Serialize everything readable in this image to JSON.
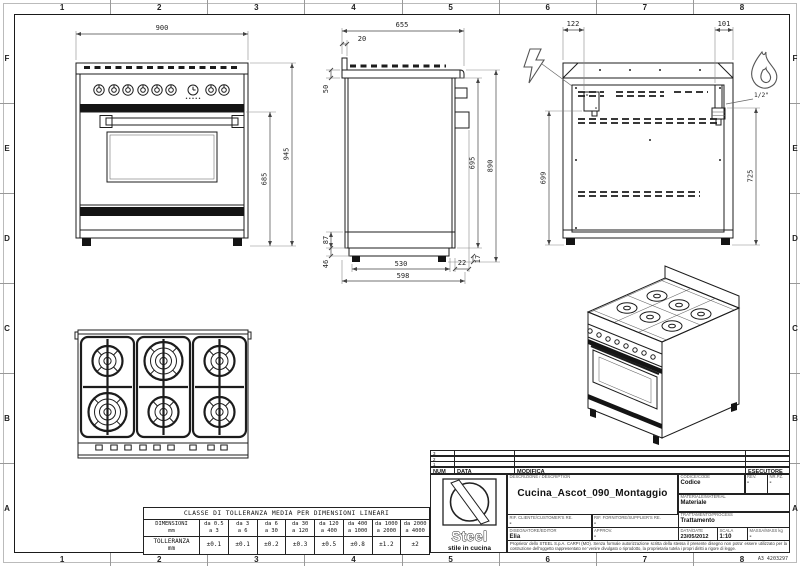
{
  "sheet_code": "A3 4203297",
  "grid": {
    "cols": [
      "1",
      "2",
      "3",
      "4",
      "5",
      "6",
      "7",
      "8"
    ],
    "rows": [
      "F",
      "E",
      "D",
      "C",
      "B",
      "A"
    ]
  },
  "views": {
    "front": {
      "dim_width": "900",
      "dim_height_total": "945",
      "dim_height_body": "685"
    },
    "side": {
      "dim_depth_top": "655",
      "dim_backsplash": "20",
      "dim_worktop": "50",
      "dim_lower": "87",
      "dim_plinth": "46",
      "dim_front_height": "695",
      "dim_height": "890",
      "dim_base_depth": "530",
      "dim_handle": "22",
      "dim_depth": "598",
      "dim_feet": "17"
    },
    "back": {
      "dim_electric_offset": "122",
      "dim_gas_offset": "101",
      "dim_electric_height": "699",
      "dim_gas_height": "725",
      "gas_connection": "1/2\""
    }
  },
  "tolerance_table": {
    "title": "CLASSE DI TOLLERANZA MEDIA PER DIMENSIONI LINEARI",
    "dimensioni_label": "DIMENSIONI",
    "tolleranza_label": "TOLLERANZA",
    "unit": "mm",
    "ranges": [
      {
        "from": "da 0.5",
        "to": "a 3",
        "tol": "±0.1"
      },
      {
        "from": "da 3",
        "to": "a 6",
        "tol": "±0.1"
      },
      {
        "from": "da 6",
        "to": "a 30",
        "tol": "±0.2"
      },
      {
        "from": "da 30",
        "to": "a 120",
        "tol": "±0.3"
      },
      {
        "from": "da 120",
        "to": "a 400",
        "tol": "±0.5"
      },
      {
        "from": "da 400",
        "to": "a 1000",
        "tol": "±0.8"
      },
      {
        "from": "da 1000",
        "to": "a 2000",
        "tol": "±1.2"
      },
      {
        "from": "da 2000",
        "to": "a 4000",
        "tol": "±2"
      }
    ]
  },
  "title_block": {
    "revision_rows": [
      "3",
      "2",
      "1"
    ],
    "headers": {
      "num": "NUM",
      "data": "DATA",
      "modifica": "MODIFICA",
      "esecutore": "ESECUTORE"
    },
    "logo": {
      "brand": "Steel",
      "tagline": "stile in cucina"
    },
    "description_label": "DESCRIZIONE / DESCRIPTION",
    "description": "Cucina_Ascot_090_Montaggio",
    "fields": {
      "codice_label": "CODICE/CODE",
      "codice": "Codice",
      "rev_label": "REV.",
      "rev": "-",
      "nrpz_label": "NR.PZ.",
      "nrpz": "-",
      "materiale_label": "MATERIALE/MATERIAL",
      "materiale": "Materiale",
      "trattamento_label": "TRATTAMENTO/PROCESS",
      "trattamento": "Trattamento",
      "rif_cliente_label": "RIF. CLIENTE/CUSTOMER'S RE.",
      "rif_cliente": "-",
      "rif_fornitore_label": "RIF. FORNITORE/SUPPLIER'S RE.",
      "rif_fornitore": "-",
      "disegnatore_label": "DISEGNATORE/EDITOR",
      "disegnatore": "Elia",
      "approv_label": "APPROV.",
      "approv": "-",
      "data_label": "DATA/DATE",
      "data": "23/05/2012",
      "scala_label": "SCALA",
      "scala": "1:10",
      "massa_label": "MASSA/MASS kg",
      "massa": "-"
    },
    "disclaimer": "Proprieta' dello STEEL S.p.A. CARPI (MO). Senza formale autorizzazione scritta della stessa il presente disegno non potra' essere utilizzato per la costruzione dell'oggetto rappresentato ne' venire divulgato o riprodotto, la proprietaria tutela i propri diritti a rigore di legge."
  }
}
